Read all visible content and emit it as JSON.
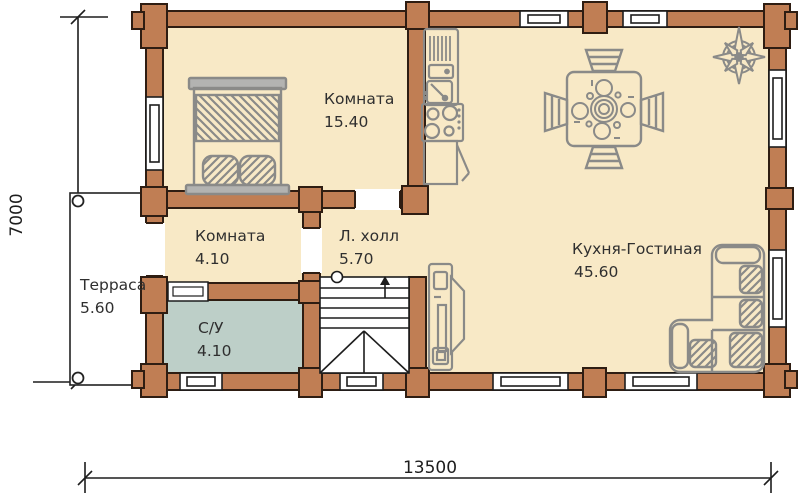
{
  "plan": {
    "rooms": {
      "bedroom": {
        "name": "Комната",
        "area": "15.40"
      },
      "entry_room": {
        "name": "Комната",
        "area": "4.10"
      },
      "hall": {
        "name": "Л. холл",
        "area": "5.70"
      },
      "terrace": {
        "name": "Терраса",
        "area": "5.60"
      },
      "bathroom": {
        "name": "С/У",
        "area": "4.10"
      },
      "kitchen_living": {
        "name": "Кухня-Гостиная",
        "area": "45.60"
      }
    },
    "dimensions": {
      "width": "13500",
      "height": "7000"
    },
    "colors": {
      "wall": "#c07e54",
      "wall_outline": "#2e1d12",
      "floor": "#f8e9c6",
      "bathroom_floor": "#bdcfc8",
      "furniture": "#8a8a88",
      "text": "#2f2f2f"
    },
    "icons": [
      "bed-icon",
      "kitchen-unit-icon",
      "dining-table-icon",
      "compass-rose-icon",
      "tv-stand-icon",
      "sofa-icon",
      "stairs-icon"
    ]
  }
}
